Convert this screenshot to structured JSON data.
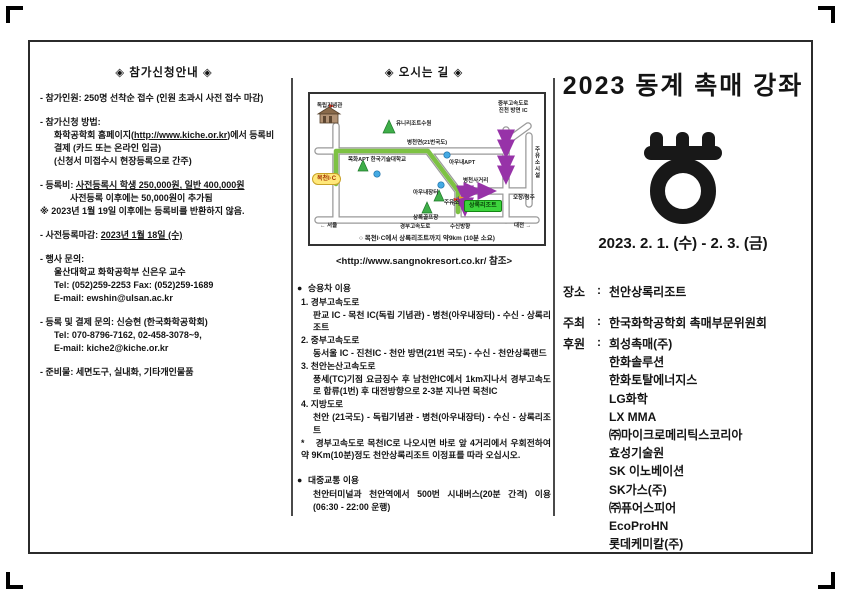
{
  "left": {
    "title": "◈ 참가신청안내 ◈",
    "paragraphs": [
      [
        {
          "i": 0,
          "s": [
            {
              "t": "- 참가인원: 250명 선착순 접수 (인원 초과시 사전 접수 마감)"
            }
          ]
        }
      ],
      [
        {
          "i": 0,
          "s": [
            {
              "t": "- 참가신청 방법:"
            }
          ]
        },
        {
          "i": 1,
          "s": [
            {
              "t": "화학공학회 홈페이지("
            },
            {
              "t": "http://www.kiche.or.kr",
              "u": true
            },
            {
              "t": ")에서 등록비"
            }
          ]
        },
        {
          "i": 1,
          "s": [
            {
              "t": "결제 (카드 또는 온라인 입금)"
            }
          ]
        },
        {
          "i": 1,
          "s": [
            {
              "t": "(신청서 미접수시 현장등록으로 간주)"
            }
          ]
        }
      ],
      [
        {
          "i": 0,
          "s": [
            {
              "t": "- 등록비: "
            },
            {
              "t": "사전등록시 학생 250,000원, 일반 400,000원",
              "u": true
            }
          ]
        },
        {
          "i": 2,
          "s": [
            {
              "t": "사전등록 이후에는 50,000원이 추가됨"
            }
          ]
        },
        {
          "i": 0,
          "s": [
            {
              "t": "※ 2023년 1월 19일 이후에는 등록비를 반환하지 않음."
            }
          ]
        }
      ],
      [
        {
          "i": 0,
          "s": [
            {
              "t": "- 사전등록마감: "
            },
            {
              "t": "2023년 1월 18일 (수)",
              "u": true
            }
          ]
        }
      ],
      [
        {
          "i": 0,
          "s": [
            {
              "t": "- 행사 문의:"
            }
          ]
        },
        {
          "i": 1,
          "s": [
            {
              "t": "울산대학교 화학공학부 신은우 교수"
            }
          ]
        },
        {
          "i": 1,
          "s": [
            {
              "t": "Tel: (052)259-2253   Fax: (052)259-1689"
            }
          ]
        },
        {
          "i": 1,
          "s": [
            {
              "t": "E-mail: ewshin@ulsan.ac.kr"
            }
          ]
        }
      ],
      [
        {
          "i": 0,
          "s": [
            {
              "t": "- 등록 및 결제 문의: 신승현 (한국화학공학회)"
            }
          ]
        },
        {
          "i": 1,
          "s": [
            {
              "t": "Tel: 070-8796-7162, 02-458-3078~9,"
            }
          ]
        },
        {
          "i": 1,
          "s": [
            {
              "t": "E-mail: kiche2@kiche.or.kr"
            }
          ]
        }
      ],
      [
        {
          "i": 0,
          "s": [
            {
              "t": "- 준비물: 세면도구, 실내화, 기타개인물품"
            }
          ]
        }
      ]
    ]
  },
  "middle": {
    "title": "◈ 오시는 길 ◈",
    "map": {
      "caption": "○ 목천I·C에서 상록리조트까지 약9km (10분 소요)",
      "link": "<http://www.sangnokresort.co.kr/ 참조>",
      "colors": {
        "route_green": "#7dc243",
        "arrow_purple": "#9733a8",
        "ic_yellow": "#ffe87a",
        "resort_green": "#3cd43c"
      },
      "labels": [
        {
          "text": "독립기념관",
          "x": 7,
          "y": 9,
          "cls": ""
        },
        {
          "text": "유니리조트수원",
          "x": 86,
          "y": 27,
          "cls": ""
        },
        {
          "text": "병천면(21번국도)",
          "x": 97,
          "y": 46,
          "cls": ""
        },
        {
          "text": "중부고속도로\n진천 방면 IC",
          "x": 188,
          "y": 7,
          "cls": "center"
        },
        {
          "text": "주유소시설",
          "x": 223,
          "y": 52,
          "cls": "vert"
        },
        {
          "text": "목화APT  한국기술대학교",
          "x": 38,
          "y": 63,
          "cls": ""
        },
        {
          "text": "아우내APT",
          "x": 139,
          "y": 66,
          "cls": ""
        },
        {
          "text": "병천사거리",
          "x": 153,
          "y": 84,
          "cls": ""
        },
        {
          "text": "아우내장터",
          "x": 103,
          "y": 96,
          "cls": ""
        },
        {
          "text": "주유소",
          "x": 134,
          "y": 106,
          "cls": ""
        },
        {
          "text": "상록골프장",
          "x": 103,
          "y": 121,
          "cls": ""
        },
        {
          "text": "오창/청주",
          "x": 203,
          "y": 101,
          "cls": ""
        },
        {
          "text": "← 서울",
          "x": 10,
          "y": 129,
          "cls": ""
        },
        {
          "text": "경부고속도로",
          "x": 90,
          "y": 130,
          "cls": ""
        },
        {
          "text": "수신방향",
          "x": 140,
          "y": 130,
          "cls": ""
        },
        {
          "text": "대전 →",
          "x": 204,
          "y": 129,
          "cls": ""
        }
      ],
      "ic_badge": "목천I·C",
      "resort_badge": "상록리조트"
    },
    "car": {
      "bullet": "●",
      "heading": "승용차 이용",
      "routes": [
        {
          "no": "1.",
          "name": "경부고속도로",
          "desc": "판교 IC - 목천 IC(독립 기념관) - 병천(아우내장터) - 수신 - 상록리조트"
        },
        {
          "no": "2.",
          "name": "중부고속도로",
          "desc": "동서울 IC - 진천IC - 천안 방면(21번 국도) - 수신 - 천안상록랜드"
        },
        {
          "no": "3.",
          "name": "천안논산고속도로",
          "desc": "풍세(TC)기점 요금징수 후 남천안IC에서 1km지나서 경부고속도로 합류(1번) 후 대전방향으로 2-3분 지나면 목천IC"
        },
        {
          "no": "4.",
          "name": "지방도로",
          "desc": "천안 (21국도) - 독립기념관 - 병천(아우내장터) - 수신 - 상록리조트"
        }
      ],
      "note_mark": "*",
      "note": "경부고속도로 목천IC로 나오시면 바로 앞 4거리에서 우회전하여 약 9Km(10분)정도 천안상록리조트 이정표를 따라 오십시오."
    },
    "transit": {
      "bullet": "●",
      "heading": "대중교통 이용",
      "body": "천안터미널과 천안역에서 500번 시내버스(20분 간격) 이용 (06:30 - 22:00 운행)"
    }
  },
  "right": {
    "title": "2023 동계 촉매 강좌",
    "logo_name": "catalysis-symbol",
    "date": "2023. 2. 1. (수) - 2. 3. (금)",
    "colon": ":",
    "venue": {
      "label": "장소",
      "value": "천안상록리조트"
    },
    "host": {
      "label": "주최",
      "value": "한국화학공학회 촉매부문위원회"
    },
    "sponsor_label": "후원",
    "sponsors": [
      "희성촉매(주)",
      "한화솔루션",
      "한화토탈에너지스",
      "LG화학",
      "LX MMA",
      "㈜마이크로메리틱스코리아",
      "효성기술원",
      "SK 이노베이션",
      "SK가스(주)",
      "㈜퓨어스피어",
      "EcoProHN",
      "롯데케미칼(주)"
    ]
  }
}
